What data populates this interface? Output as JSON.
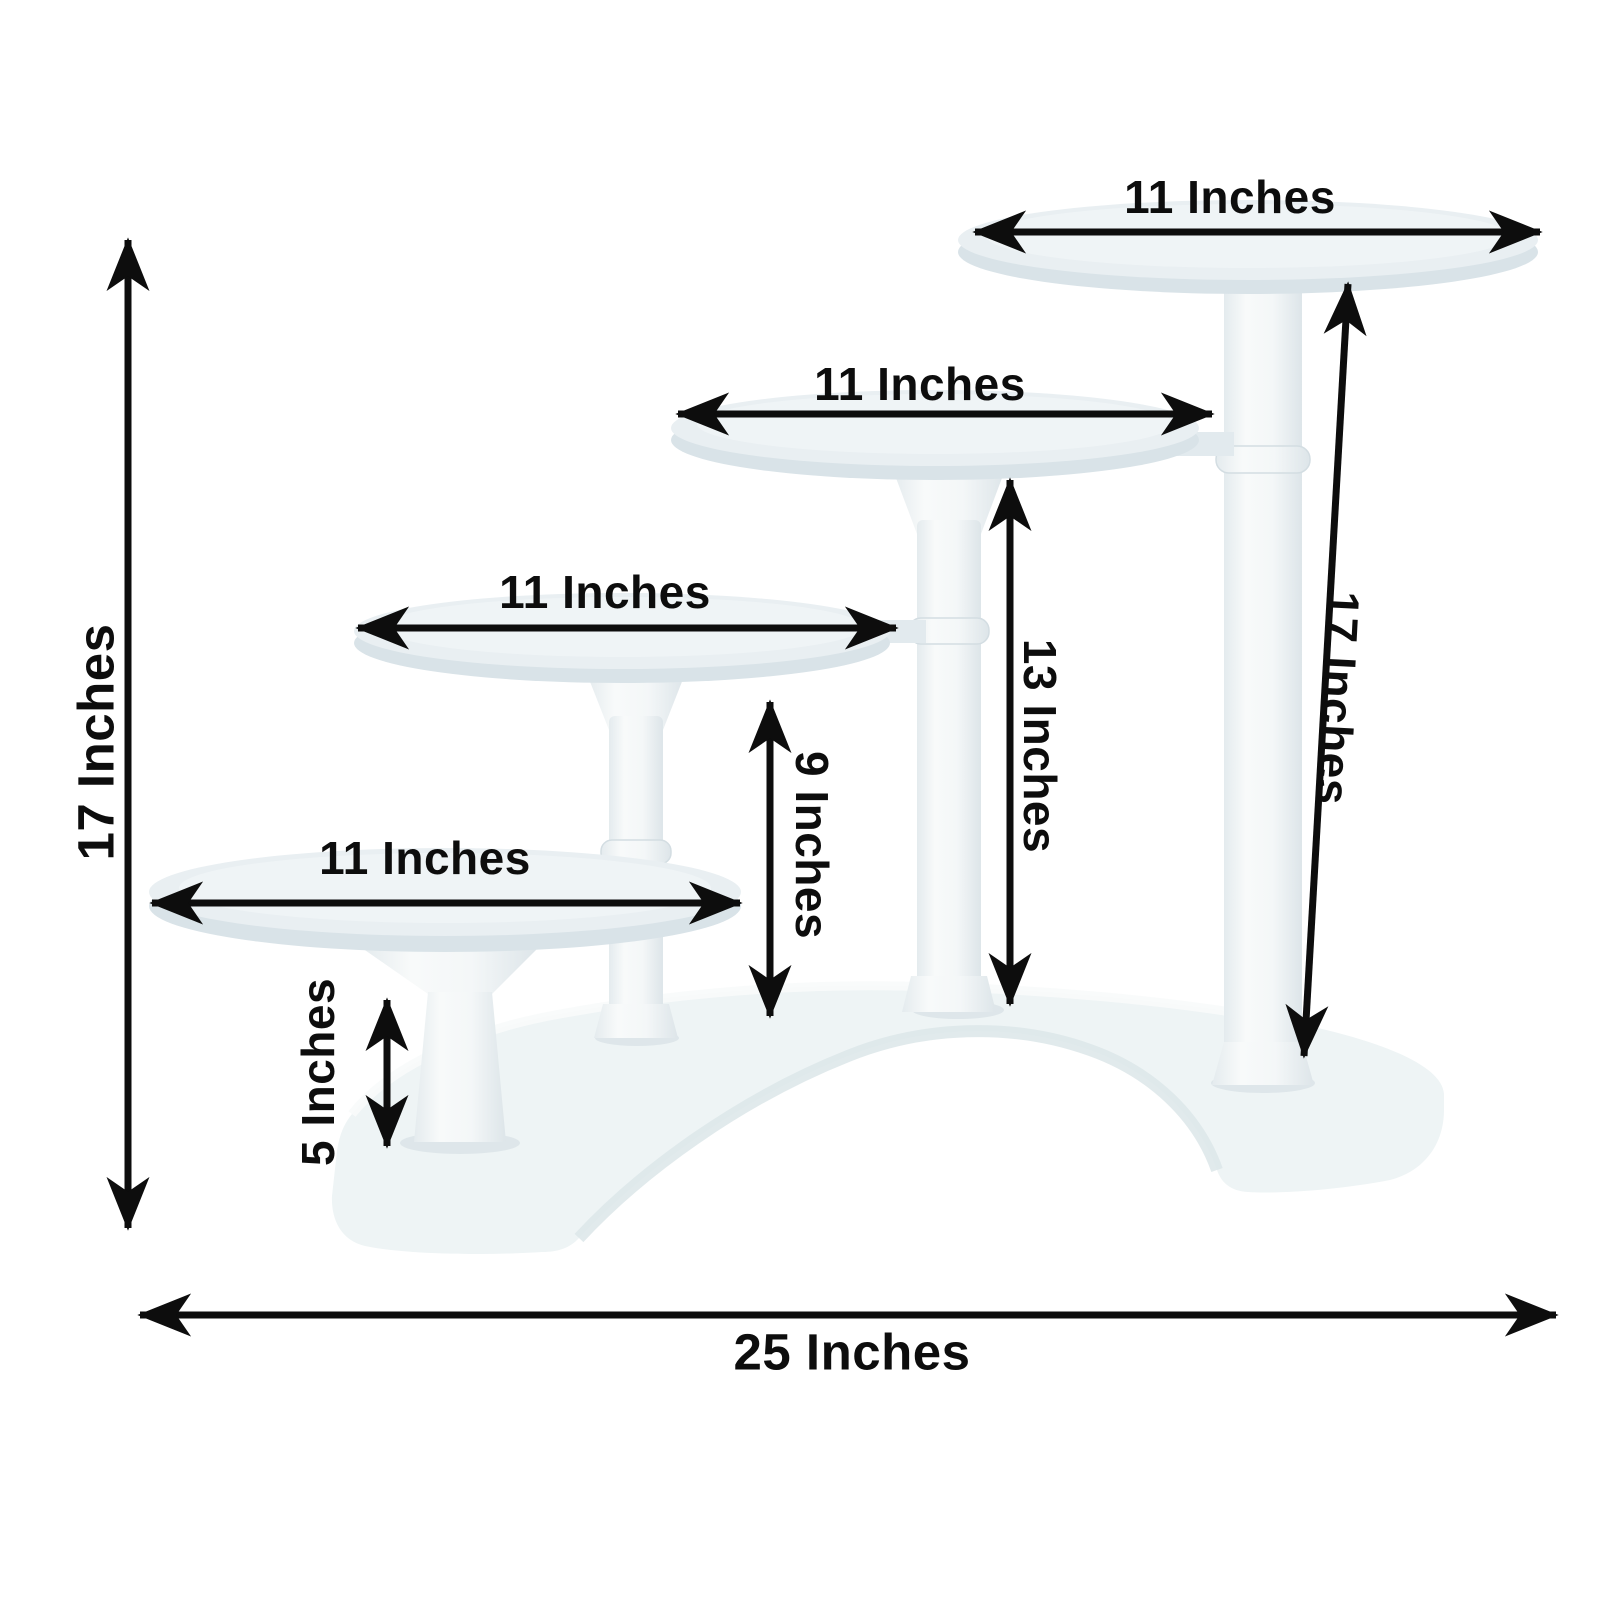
{
  "figure": {
    "subject": "4-tier crescent cake stand dimension diagram"
  },
  "labels": {
    "tier1_diameter": "11 Inches",
    "tier2_diameter": "11 Inches",
    "tier3_diameter": "11 Inches",
    "tier4_diameter": "11 Inches",
    "overall_height": "17 Inches",
    "overall_width": "25 Inches",
    "tier1_column_height": "17 Inches",
    "tier2_column_height": "13 Inches",
    "tier3_column_height": "9 Inches",
    "tier4_column_height": "5 Inches"
  },
  "colors": {
    "annotation": "#0d0d0d",
    "background": "#ffffff",
    "plate_top": "#e9eff2",
    "plate_rim": "#d9e3e8",
    "pillar_light": "#f7f9fa",
    "pillar_shade": "#dfe7ea",
    "base": "#eef4f5"
  }
}
